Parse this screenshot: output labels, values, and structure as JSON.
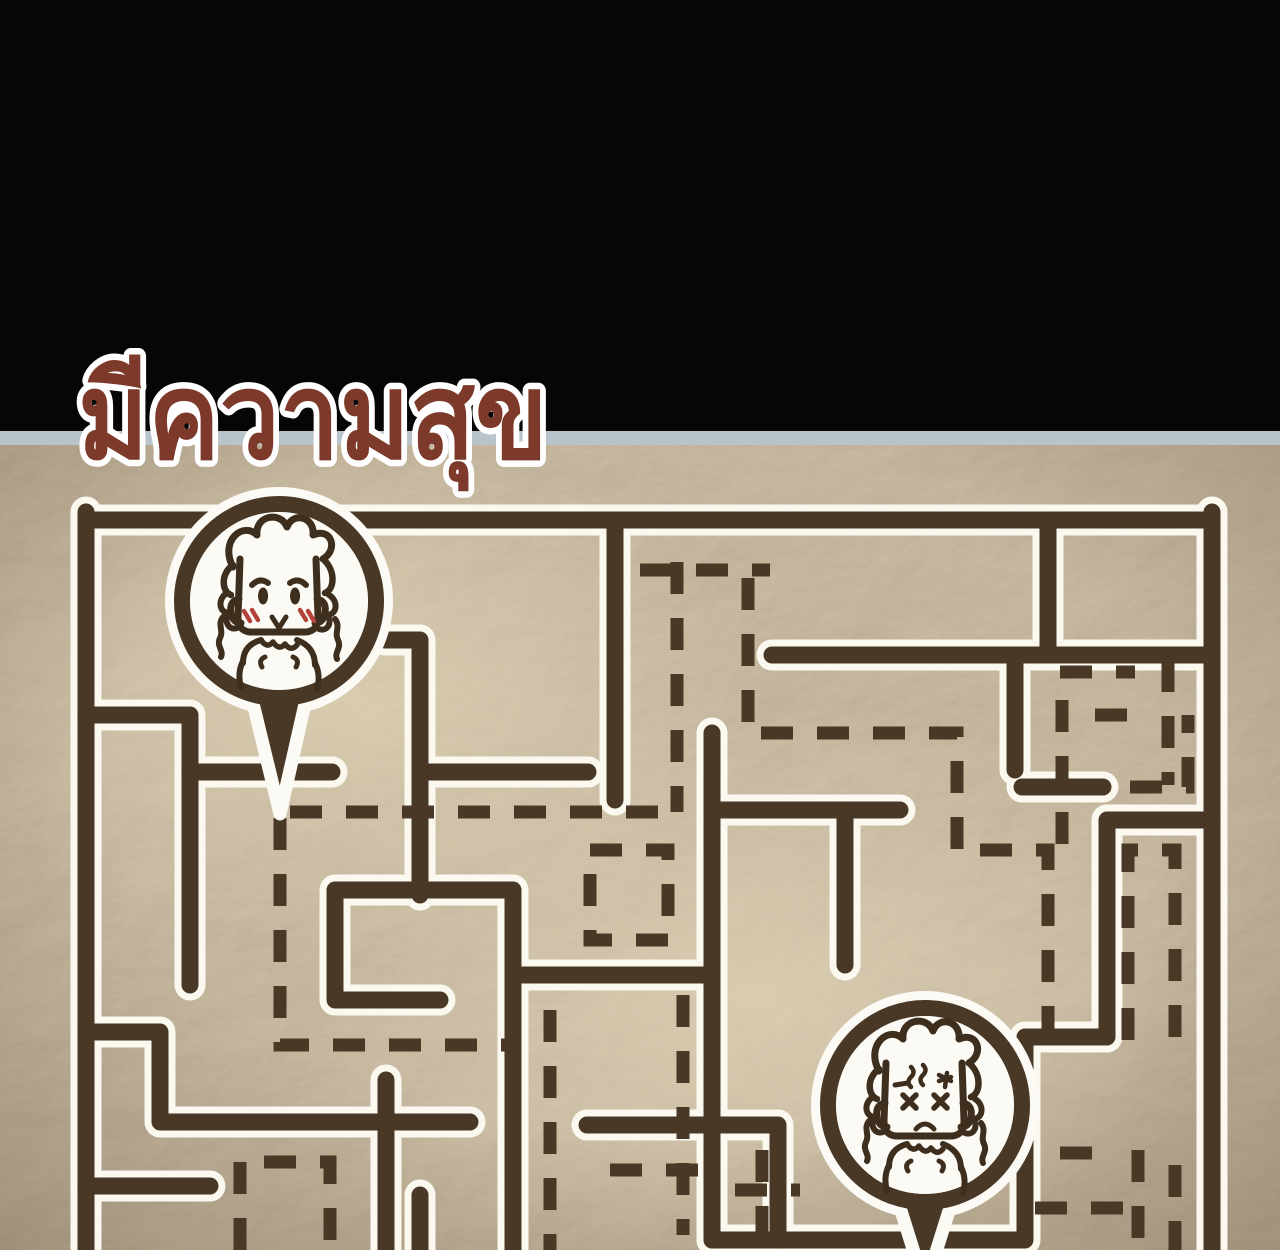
{
  "panel": {
    "width": 1280,
    "height": 1250
  },
  "title": {
    "text": "มีความสุข",
    "color": "#7d392a",
    "outline_color": "#ffffff"
  },
  "colors": {
    "header_band": "#060606",
    "divider_line": "#b9c4ca",
    "parchment": "#cfc0a6",
    "parchment_light": "#e6dcc2",
    "parchment_shadow": "#4a3826",
    "ink": "#4a3826",
    "wall_outline": "#fbf8f0",
    "sketch": "#3d2e1d",
    "blush": "#b2423a",
    "pin_fill": "#fcfaf4"
  },
  "layout": {
    "header_height": 434,
    "divider_y": 431,
    "divider_height": 14,
    "title_x": 78,
    "title_y": 458,
    "title_size": 120,
    "title_length": 470
  },
  "maze": {
    "wall_thickness": 17,
    "outline_thickness": 31,
    "dash_thickness": 13,
    "dash_pattern": "32 24",
    "solid_walls": [
      "M 86 520 H 1212",
      "M 86 512 V 1250",
      "M 1212 512 V 1250",
      "M 86 715 H 190 V 985",
      "M 190 772 H 332",
      "M 385 640 H 420 V 895",
      "M 428 772 H 588",
      "M 615 520 V 800",
      "M 86 1032 H 160 V 1122 H 470",
      "M 386 1080 V 1250",
      "M 86 1186 H 210",
      "M 440 1000 H 335 V 890 H 513 V 1250",
      "M 513 975 H 712",
      "M 772 655 H 1212",
      "M 1048 520 V 655",
      "M 1015 655 V 770",
      "M 1022 787 H 1103",
      "M 1212 820 H 1107 V 1037 H 1025 V 1240 H 712",
      "M 712 733 V 1240",
      "M 712 810 H 900",
      "M 845 810 V 965",
      "M 587 1125 H 778 V 1240",
      "M 420 1195 V 1250"
    ],
    "dashed_paths": [
      "M 677 562 V 812",
      "M 640 570 H 770",
      "M 748 578 V 733 H 957 V 850 H 1048 V 1035",
      "M 290 812 H 665",
      "M 280 818 V 1045 H 505",
      "M 590 850 H 668 V 940 H 590 V 856",
      "M 240 1250 V 1162 H 330 V 1250",
      "M 1060 672 H 1135",
      "M 1168 660 V 785",
      "M 1095 715 H 1150",
      "M 1062 700 V 855",
      "M 1130 787 H 1188 V 715",
      "M 1128 1040 V 850 H 1175 V 1040",
      "M 1035 1208 H 1140",
      "M 1138 1150 V 1250",
      "M 1060 1153 H 1110",
      "M 1175 1165 V 1250",
      "M 762 1150 V 1250",
      "M 735 1190 H 800",
      "M 550 1010 V 1250",
      "M 610 1170 H 700",
      "M 683 995 V 1235"
    ]
  },
  "pins": [
    {
      "name": "happy-character-pin",
      "cx": 279,
      "cy": 601,
      "r_outer": 114,
      "r_ring": 97,
      "ring_width": 16,
      "r_inner": 89,
      "tail": "M 251 695 L 307 695 L 280 814 Z",
      "character": "happy"
    },
    {
      "name": "dizzy-character-pin",
      "cx": 925,
      "cy": 1105,
      "r_outer": 114,
      "r_ring": 97,
      "ring_width": 16,
      "r_inner": 89,
      "tail": "M 897 1198 L 953 1198 L 925 1287 Z",
      "character": "dizzy"
    }
  ],
  "characters": {
    "base": [
      {
        "d": "M -39 -42 L -41 16 Q -41 30 -29 31 L 27 31 Q 39 30 39 16 L 37 -42",
        "sw": 7
      },
      {
        "d": "M -46 -34 C -60 -60 -36 -80 -22 -66 C -24 -86 2 -90 8 -74 C 14 -90 36 -84 34 -66 C 52 -74 60 -52 44 -42",
        "sw": 7
      },
      {
        "d": "M -46 -36 C -58 -28 -58 -10 -48 -6",
        "sw": 6.5
      },
      {
        "d": "M 46 -40 C 56 -30 56 -12 46 -8",
        "sw": 6.5
      },
      {
        "d": "M -52 -8 C -62 -2 -60 12 -50 12 C -56 20 -50 30 -42 27",
        "sw": 6
      },
      {
        "d": "M -56 16 C -62 24 -55 29 -59 37 C -63 45 -55 49 -58 56",
        "sw": 6
      },
      {
        "d": "M 50 -6 C 60 0 58 14 48 14 C 54 22 48 31 40 28",
        "sw": 6
      },
      {
        "d": "M 56 18 C 62 26 55 31 59 39 C 63 47 55 51 58 58",
        "sw": 6
      },
      {
        "d": "M -40 -2 Q -50 0 -48 12 Q -46 22 -38 22",
        "sw": 7
      },
      {
        "d": "M 38 -2 Q 48 0 46 12 Q 44 22 36 22",
        "sw": 7
      },
      {
        "d": "M -36 62 Q -36 44 -18 39",
        "sw": 6
      },
      {
        "d": "M 36 64 Q 36 46 18 39",
        "sw": 6
      },
      {
        "d": "M -18 39 q 6 9 12 2 q 6 9 12 2 q 6 8 12 1",
        "sw": 5.5
      },
      {
        "d": "M -14 56 q -7 3 -3 10",
        "sw": 5
      },
      {
        "d": "M 14 56 q 7 3 3 10",
        "sw": 5
      },
      {
        "d": "M -36 60 Q -42 72 -38 86",
        "sw": 6
      },
      {
        "d": "M 36 62 Q 42 74 38 88",
        "sw": 6
      }
    ],
    "happy": [
      {
        "d": "M -27 -16 Q -19 -24 -11 -18",
        "sw": 6
      },
      {
        "d": "M 11 -18 Q 19 -24 27 -16",
        "sw": 6
      },
      {
        "d": "M -16 -13 a 4.5 8 0 1 0 0.1 0 Z",
        "sw": 1,
        "fill": true
      },
      {
        "d": "M 16 -13 a 4.5 8 0 1 0 0.1 0 Z",
        "sw": 1,
        "fill": true
      },
      {
        "d": "M -7 16 L 0 27 L 7 16",
        "sw": 5
      },
      {
        "d": "M -35 10 l 6 10",
        "sw": 4.5,
        "blush": true
      },
      {
        "d": "M -27 9 l 6 10",
        "sw": 4.5,
        "blush": true
      },
      {
        "d": "M 21 9 l 6 10",
        "sw": 4.5,
        "blush": true
      },
      {
        "d": "M 29 10 l 6 10",
        "sw": 4.5,
        "blush": true
      }
    ],
    "dizzy": [
      {
        "d": "M -22 -10 l 13 13",
        "sw": 5.5
      },
      {
        "d": "M -9 -10 l -13 13",
        "sw": 5.5
      },
      {
        "d": "M 9 -10 l 13 13",
        "sw": 5.5
      },
      {
        "d": "M 22 -10 l -13 13",
        "sw": 5.5
      },
      {
        "d": "M -30 -20 l 13 -2",
        "sw": 5
      },
      {
        "d": "M -14 -38 q 5 5 0 10 q -5 5 0 10",
        "sw": 4.5
      },
      {
        "d": "M -2 -40 q 5 5 0 10 q -5 5 0 10",
        "sw": 4.5
      },
      {
        "d": "M 14 -30 l 12 6 M 14 -24 l 12 -4 M 22 -32 l -2 14",
        "sw": 4.5
      },
      {
        "d": "M -9 24 Q 0 14 9 24",
        "sw": 5
      }
    ]
  }
}
